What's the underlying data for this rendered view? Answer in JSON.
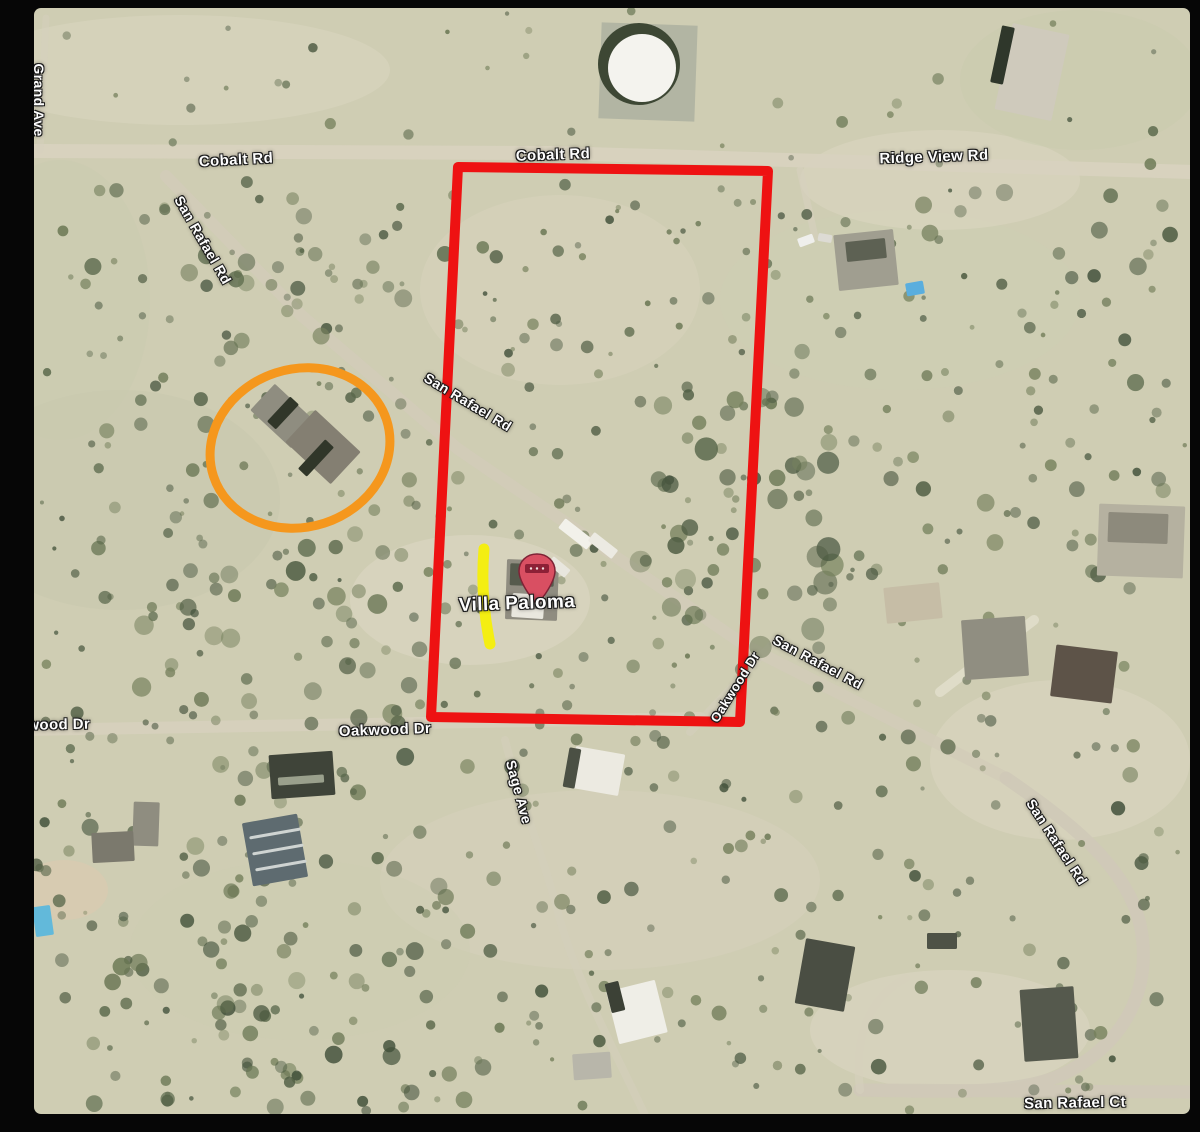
{
  "map": {
    "description": "Aerial satellite view of desert parcels with property boundary markup",
    "pin": {
      "label": "Villa Paloma",
      "x": 503,
      "y": 560
    },
    "labels": [
      {
        "id": "road-label-cobalt-rd-west",
        "text": "Cobalt Rd",
        "x": 202,
        "y": 152,
        "rot": -3,
        "size": 15
      },
      {
        "id": "road-label-cobalt-rd-center",
        "text": "Cobalt Rd",
        "x": 519,
        "y": 147,
        "rot": -2,
        "size": 15
      },
      {
        "id": "road-label-ridge-view-rd",
        "text": "Ridge View Rd",
        "x": 900,
        "y": 149,
        "rot": -2,
        "size": 15
      },
      {
        "id": "road-label-san-rafael-rd-nw",
        "text": "San Rafael Rd",
        "x": 169,
        "y": 232,
        "rot": 60,
        "size": 14
      },
      {
        "id": "road-label-san-rafael-rd-mid",
        "text": "San Rafael Rd",
        "x": 434,
        "y": 394,
        "rot": 31,
        "size": 14
      },
      {
        "id": "road-label-san-rafael-rd-east",
        "text": "San Rafael Rd",
        "x": 784,
        "y": 654,
        "rot": 28,
        "size": 14
      },
      {
        "id": "road-label-san-rafael-rd-south",
        "text": "San Rafael Rd",
        "x": 1023,
        "y": 834,
        "rot": 57,
        "size": 14
      },
      {
        "id": "road-label-oakwood-dr-west",
        "text": "Oakwood Dr",
        "x": 10,
        "y": 717,
        "rot": -1,
        "size": 15
      },
      {
        "id": "road-label-oakwood-dr-center",
        "text": "Oakwood Dr",
        "x": 351,
        "y": 722,
        "rot": -2,
        "size": 15
      },
      {
        "id": "road-label-oakwood-dr-diag",
        "text": "Oakwood Dr",
        "x": 701,
        "y": 679,
        "rot": -58,
        "size": 13
      },
      {
        "id": "road-label-sage-ave",
        "text": "Sage Ave",
        "x": 485,
        "y": 784,
        "rot": 75,
        "size": 14
      },
      {
        "id": "road-label-san-rafael-ct",
        "text": "San Rafael Ct",
        "x": 1041,
        "y": 1095,
        "rot": -1,
        "size": 15
      },
      {
        "id": "road-label-grand-ave",
        "text": "Grand Ave",
        "x": 5,
        "y": 92,
        "rot": 90,
        "size": 14
      },
      {
        "id": "place-label-villa-paloma",
        "text": "Villa Paloma",
        "x": 483,
        "y": 596,
        "rot": -2,
        "size": 19
      }
    ],
    "annotations": {
      "red_boundary": {
        "name": "property-boundary-outline",
        "color": "#ee1212",
        "points": "424,159 734,163 706,714 397,709",
        "stroke_width": 10
      },
      "orange_circle": {
        "name": "neighbor-house-circle",
        "color": "#f5971d",
        "cx": 266,
        "cy": 440,
        "rx": 91,
        "ry": 79,
        "rot": -18,
        "stroke_width": 9
      },
      "yellow_mark": {
        "name": "yellow-highlight-line",
        "color": "#f4ee12",
        "d": "M 450,541 Q 446,588 456,636",
        "stroke_width": 11
      },
      "pin_color": "#d94f62",
      "pin_band_color": "#8d2036"
    },
    "roads": [
      {
        "id": "road-cobalt-ridgeview",
        "d": "M -4,143 L 520,145 L 1158,164",
        "w": 14,
        "c": "#d8d2bf",
        "o": 0.95
      },
      {
        "id": "road-san-rafael-main",
        "d": "M 132,168 L 268,308 L 424,441 L 588,553 L 712,638 L 972,770",
        "w": 12,
        "c": "#d2ccb9",
        "o": 0.8
      },
      {
        "id": "road-san-rafael-south",
        "d": "M 972,770 C 1030,810 1092,856 1106,916 C 1119,976 1095,1036 1025,1068 C 980,1086 920,1084 826,1082",
        "w": 13,
        "c": "#cfc9b8",
        "o": 0.9
      },
      {
        "id": "road-san-rafael-ct",
        "d": "M 826,1082 L 1158,1084",
        "w": 13,
        "c": "#cfc9b8",
        "o": 0.9
      },
      {
        "id": "road-oakwood",
        "d": "M -4,722 L 666,710",
        "w": 12,
        "c": "#d6d0bd",
        "o": 0.9
      },
      {
        "id": "road-oakwood-diag",
        "d": "M 656,724 L 742,632",
        "w": 8,
        "c": "#d6d0bd",
        "o": 0.55
      },
      {
        "id": "road-sage-ave",
        "d": "M 471,732 C 486,792 511,852 526,912 C 546,982 586,1052 616,1118",
        "w": 8,
        "c": "#d4cebb",
        "o": 0.6
      },
      {
        "id": "road-ridgeview-drive",
        "d": "M 766,162 L 781,229",
        "w": 7,
        "c": "#d6d0bd",
        "o": 0.7
      },
      {
        "id": "road-left-track",
        "d": "M 12,10 L 6,142",
        "w": 7,
        "c": "#d6d0bd",
        "o": 0.5
      },
      {
        "id": "road-mid-right-drive",
        "d": "M 906,684 L 1000,612",
        "w": 10,
        "c": "#e6e2d2",
        "o": 0.7
      },
      {
        "id": "road-court-drive",
        "d": "M 826,1082 C 820,1030 834,990 872,970",
        "w": 8,
        "c": "#d6d0bd",
        "o": 0.6
      }
    ],
    "water_tank": {
      "pad": {
        "x": 566,
        "y": 16,
        "w": 96,
        "h": 96,
        "fill": "#b2b5a3"
      },
      "ring": {
        "cx": 605,
        "cy": 56,
        "r": 41,
        "fill": "#3d4734"
      },
      "top": {
        "cx": 608,
        "cy": 60,
        "r": 34,
        "fill": "#f4f3ee"
      }
    },
    "buildings": [
      {
        "id": "barn-top-right",
        "x": 969,
        "y": 20,
        "w": 58,
        "h": 88,
        "rot": 12,
        "fill": "#cfcabc"
      },
      {
        "id": "barn-edge",
        "x": 962,
        "y": 18,
        "w": 13,
        "h": 58,
        "rot": 12,
        "fill": "#2f372b"
      },
      {
        "id": "house-ne-cluster",
        "x": 802,
        "y": 224,
        "w": 60,
        "h": 56,
        "rot": -6,
        "fill": "#a09e90"
      },
      {
        "id": "house-ne-roof",
        "x": 812,
        "y": 232,
        "w": 40,
        "h": 20,
        "rot": -6,
        "fill": "#5d6153"
      },
      {
        "id": "vehicle-1",
        "x": 764,
        "y": 228,
        "w": 16,
        "h": 9,
        "rot": -20,
        "fill": "#efefec"
      },
      {
        "id": "vehicle-2",
        "x": 784,
        "y": 226,
        "w": 14,
        "h": 8,
        "rot": 10,
        "fill": "#dddbd4"
      },
      {
        "id": "blue-tarp",
        "x": 872,
        "y": 274,
        "w": 18,
        "h": 13,
        "rot": -10,
        "fill": "#5aaede"
      },
      {
        "id": "circled-house-a",
        "x": 221,
        "y": 390,
        "w": 56,
        "h": 36,
        "rot": 43,
        "fill": "#8f8d80"
      },
      {
        "id": "circled-house-b",
        "x": 258,
        "y": 417,
        "w": 62,
        "h": 44,
        "rot": 43,
        "fill": "#847f72"
      },
      {
        "id": "circled-house-roof1",
        "x": 243,
        "y": 388,
        "w": 12,
        "h": 34,
        "rot": 43,
        "fill": "#303629"
      },
      {
        "id": "circled-house-roof2",
        "x": 276,
        "y": 430,
        "w": 12,
        "h": 40,
        "rot": 43,
        "fill": "#303629"
      },
      {
        "id": "villa-paloma-house",
        "x": 472,
        "y": 552,
        "w": 52,
        "h": 60,
        "rot": 2,
        "fill": "#8f8c80"
      },
      {
        "id": "villa-paloma-roof",
        "x": 476,
        "y": 556,
        "w": 44,
        "h": 22,
        "rot": 2,
        "fill": "#565b4d"
      },
      {
        "id": "villa-paloma-white",
        "x": 478,
        "y": 586,
        "w": 32,
        "h": 24,
        "rot": 4,
        "fill": "#e9e7de"
      },
      {
        "id": "trailer-1",
        "x": 524,
        "y": 520,
        "w": 36,
        "h": 12,
        "rot": 38,
        "fill": "#f2f1ea"
      },
      {
        "id": "trailer-2",
        "x": 554,
        "y": 532,
        "w": 30,
        "h": 11,
        "rot": 38,
        "fill": "#eceae2"
      },
      {
        "id": "trailer-3",
        "x": 520,
        "y": 548,
        "w": 10,
        "h": 22,
        "rot": -50,
        "fill": "#e8e6de"
      },
      {
        "id": "house-right-big",
        "x": 1064,
        "y": 497,
        "w": 86,
        "h": 72,
        "rot": 2,
        "fill": "#b5b1a0"
      },
      {
        "id": "house-right-roof",
        "x": 1074,
        "y": 505,
        "w": 60,
        "h": 30,
        "rot": 2,
        "fill": "#8d8a7c"
      },
      {
        "id": "house-mid-right",
        "x": 929,
        "y": 610,
        "w": 64,
        "h": 60,
        "rot": -4,
        "fill": "#908e81"
      },
      {
        "id": "house-brown-right",
        "x": 1019,
        "y": 640,
        "w": 62,
        "h": 52,
        "rot": 7,
        "fill": "#5d5348"
      },
      {
        "id": "house-tan-right",
        "x": 851,
        "y": 577,
        "w": 56,
        "h": 36,
        "rot": -6,
        "fill": "#c6bda6"
      },
      {
        "id": "oakwood-dark-bldg",
        "x": 236,
        "y": 745,
        "w": 64,
        "h": 44,
        "rot": -4,
        "fill": "#3f4439"
      },
      {
        "id": "oakwood-bldg-streak",
        "x": 244,
        "y": 768,
        "w": 46,
        "h": 8,
        "rot": -4,
        "fill": "#9aa08c"
      },
      {
        "id": "house-left-small",
        "x": 99,
        "y": 794,
        "w": 26,
        "h": 44,
        "rot": 2,
        "fill": "#8f8d80"
      },
      {
        "id": "house-left-small2",
        "x": 58,
        "y": 824,
        "w": 42,
        "h": 30,
        "rot": -3,
        "fill": "#7b796d"
      },
      {
        "id": "solar-array",
        "x": 213,
        "y": 810,
        "w": 56,
        "h": 64,
        "rot": -10,
        "fill": "#5e6b70"
      },
      {
        "id": "solar-stripe-1",
        "x": 215,
        "y": 824,
        "w": 52,
        "h": 3,
        "rot": -10,
        "fill": "#cfd4d2"
      },
      {
        "id": "solar-stripe-2",
        "x": 218,
        "y": 840,
        "w": 52,
        "h": 3,
        "rot": -10,
        "fill": "#cfd4d2"
      },
      {
        "id": "solar-stripe-3",
        "x": 221,
        "y": 856,
        "w": 52,
        "h": 3,
        "rot": -10,
        "fill": "#cfd4d2"
      },
      {
        "id": "sage-white-house",
        "x": 538,
        "y": 742,
        "w": 50,
        "h": 42,
        "rot": 10,
        "fill": "#eceae1"
      },
      {
        "id": "sage-house-edge",
        "x": 532,
        "y": 740,
        "w": 12,
        "h": 40,
        "rot": 10,
        "fill": "#4b5044"
      },
      {
        "id": "bottom-white-house",
        "x": 578,
        "y": 977,
        "w": 50,
        "h": 54,
        "rot": -14,
        "fill": "#efeee7"
      },
      {
        "id": "bottom-white-edge",
        "x": 574,
        "y": 974,
        "w": 14,
        "h": 30,
        "rot": -14,
        "fill": "#3c4136"
      },
      {
        "id": "bottom-gray-shed",
        "x": 539,
        "y": 1045,
        "w": 38,
        "h": 26,
        "rot": -4,
        "fill": "#b8b6aa"
      },
      {
        "id": "bottom-dark-house",
        "x": 766,
        "y": 934,
        "w": 50,
        "h": 66,
        "rot": 10,
        "fill": "#4a4e43"
      },
      {
        "id": "bottom-right-house",
        "x": 988,
        "y": 980,
        "w": 54,
        "h": 72,
        "rot": -4,
        "fill": "#55594d"
      },
      {
        "id": "small-dark-shed",
        "x": 893,
        "y": 925,
        "w": 30,
        "h": 16,
        "rot": 0,
        "fill": "#4e5246"
      },
      {
        "id": "pool",
        "x": 0,
        "y": 898,
        "w": 18,
        "h": 30,
        "rot": -8,
        "fill": "#62b9da"
      }
    ],
    "patches": [
      {
        "cx": 436,
        "cy": 592,
        "rx": 120,
        "ry": 65,
        "fill": "#ded9c4",
        "o": 0.55
      },
      {
        "cx": 146,
        "cy": 62,
        "rx": 210,
        "ry": 55,
        "fill": "#dcd7c2",
        "o": 0.5
      },
      {
        "cx": 526,
        "cy": 282,
        "rx": 140,
        "ry": 95,
        "fill": "#d9d5bf",
        "o": 0.45
      },
      {
        "cx": 866,
        "cy": 292,
        "rx": 180,
        "ry": 90,
        "fill": "#cdd0b4",
        "o": 0.4
      },
      {
        "cx": 906,
        "cy": 172,
        "rx": 140,
        "ry": 50,
        "fill": "#ddd8c3",
        "o": 0.5
      },
      {
        "cx": 1026,
        "cy": 752,
        "rx": 130,
        "ry": 80,
        "fill": "#ddd8c3",
        "o": 0.5
      },
      {
        "cx": 566,
        "cy": 872,
        "rx": 220,
        "ry": 90,
        "fill": "#d7d2bd",
        "o": 0.5
      },
      {
        "cx": 916,
        "cy": 1022,
        "rx": 140,
        "ry": 60,
        "fill": "#dcd7c2",
        "o": 0.55
      },
      {
        "cx": 86,
        "cy": 492,
        "rx": 160,
        "ry": 110,
        "fill": "#c6c8ac",
        "o": 0.45
      },
      {
        "cx": 266,
        "cy": 942,
        "rx": 170,
        "ry": 90,
        "fill": "#ccceb2",
        "o": 0.4
      },
      {
        "cx": 1046,
        "cy": 72,
        "rx": 120,
        "ry": 70,
        "fill": "#c8cbae",
        "o": 0.45
      },
      {
        "cx": 26,
        "cy": 292,
        "rx": 90,
        "ry": 140,
        "fill": "#c9cbaf",
        "o": 0.4
      },
      {
        "cx": 30,
        "cy": 882,
        "rx": 44,
        "ry": 30,
        "fill": "#d8cbb0",
        "o": 0.8
      }
    ]
  }
}
